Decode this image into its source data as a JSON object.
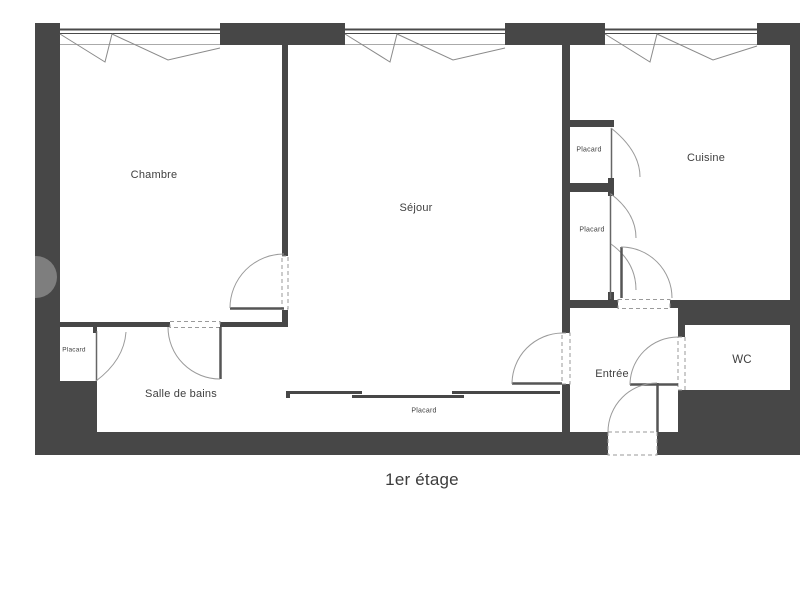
{
  "floor_plan": {
    "title": "1er étage",
    "rooms": [
      {
        "id": "chambre",
        "label": "Chambre"
      },
      {
        "id": "sejour",
        "label": "Séjour"
      },
      {
        "id": "cuisine",
        "label": "Cuisine"
      },
      {
        "id": "placard-cuisine-haut",
        "label": "Placard"
      },
      {
        "id": "placard-cuisine-bas",
        "label": "Placard"
      },
      {
        "id": "salle-de-bains",
        "label": "Salle de bains"
      },
      {
        "id": "placard-salle-de-bains",
        "label": "Placard"
      },
      {
        "id": "placard-sejour",
        "label": "Placard"
      },
      {
        "id": "entree",
        "label": "Entrée"
      },
      {
        "id": "wc",
        "label": "WC"
      }
    ],
    "colors": {
      "wall": "#474747",
      "line": "#9a9a9a",
      "text": "#3f3f3f",
      "background": "#ffffff"
    }
  }
}
